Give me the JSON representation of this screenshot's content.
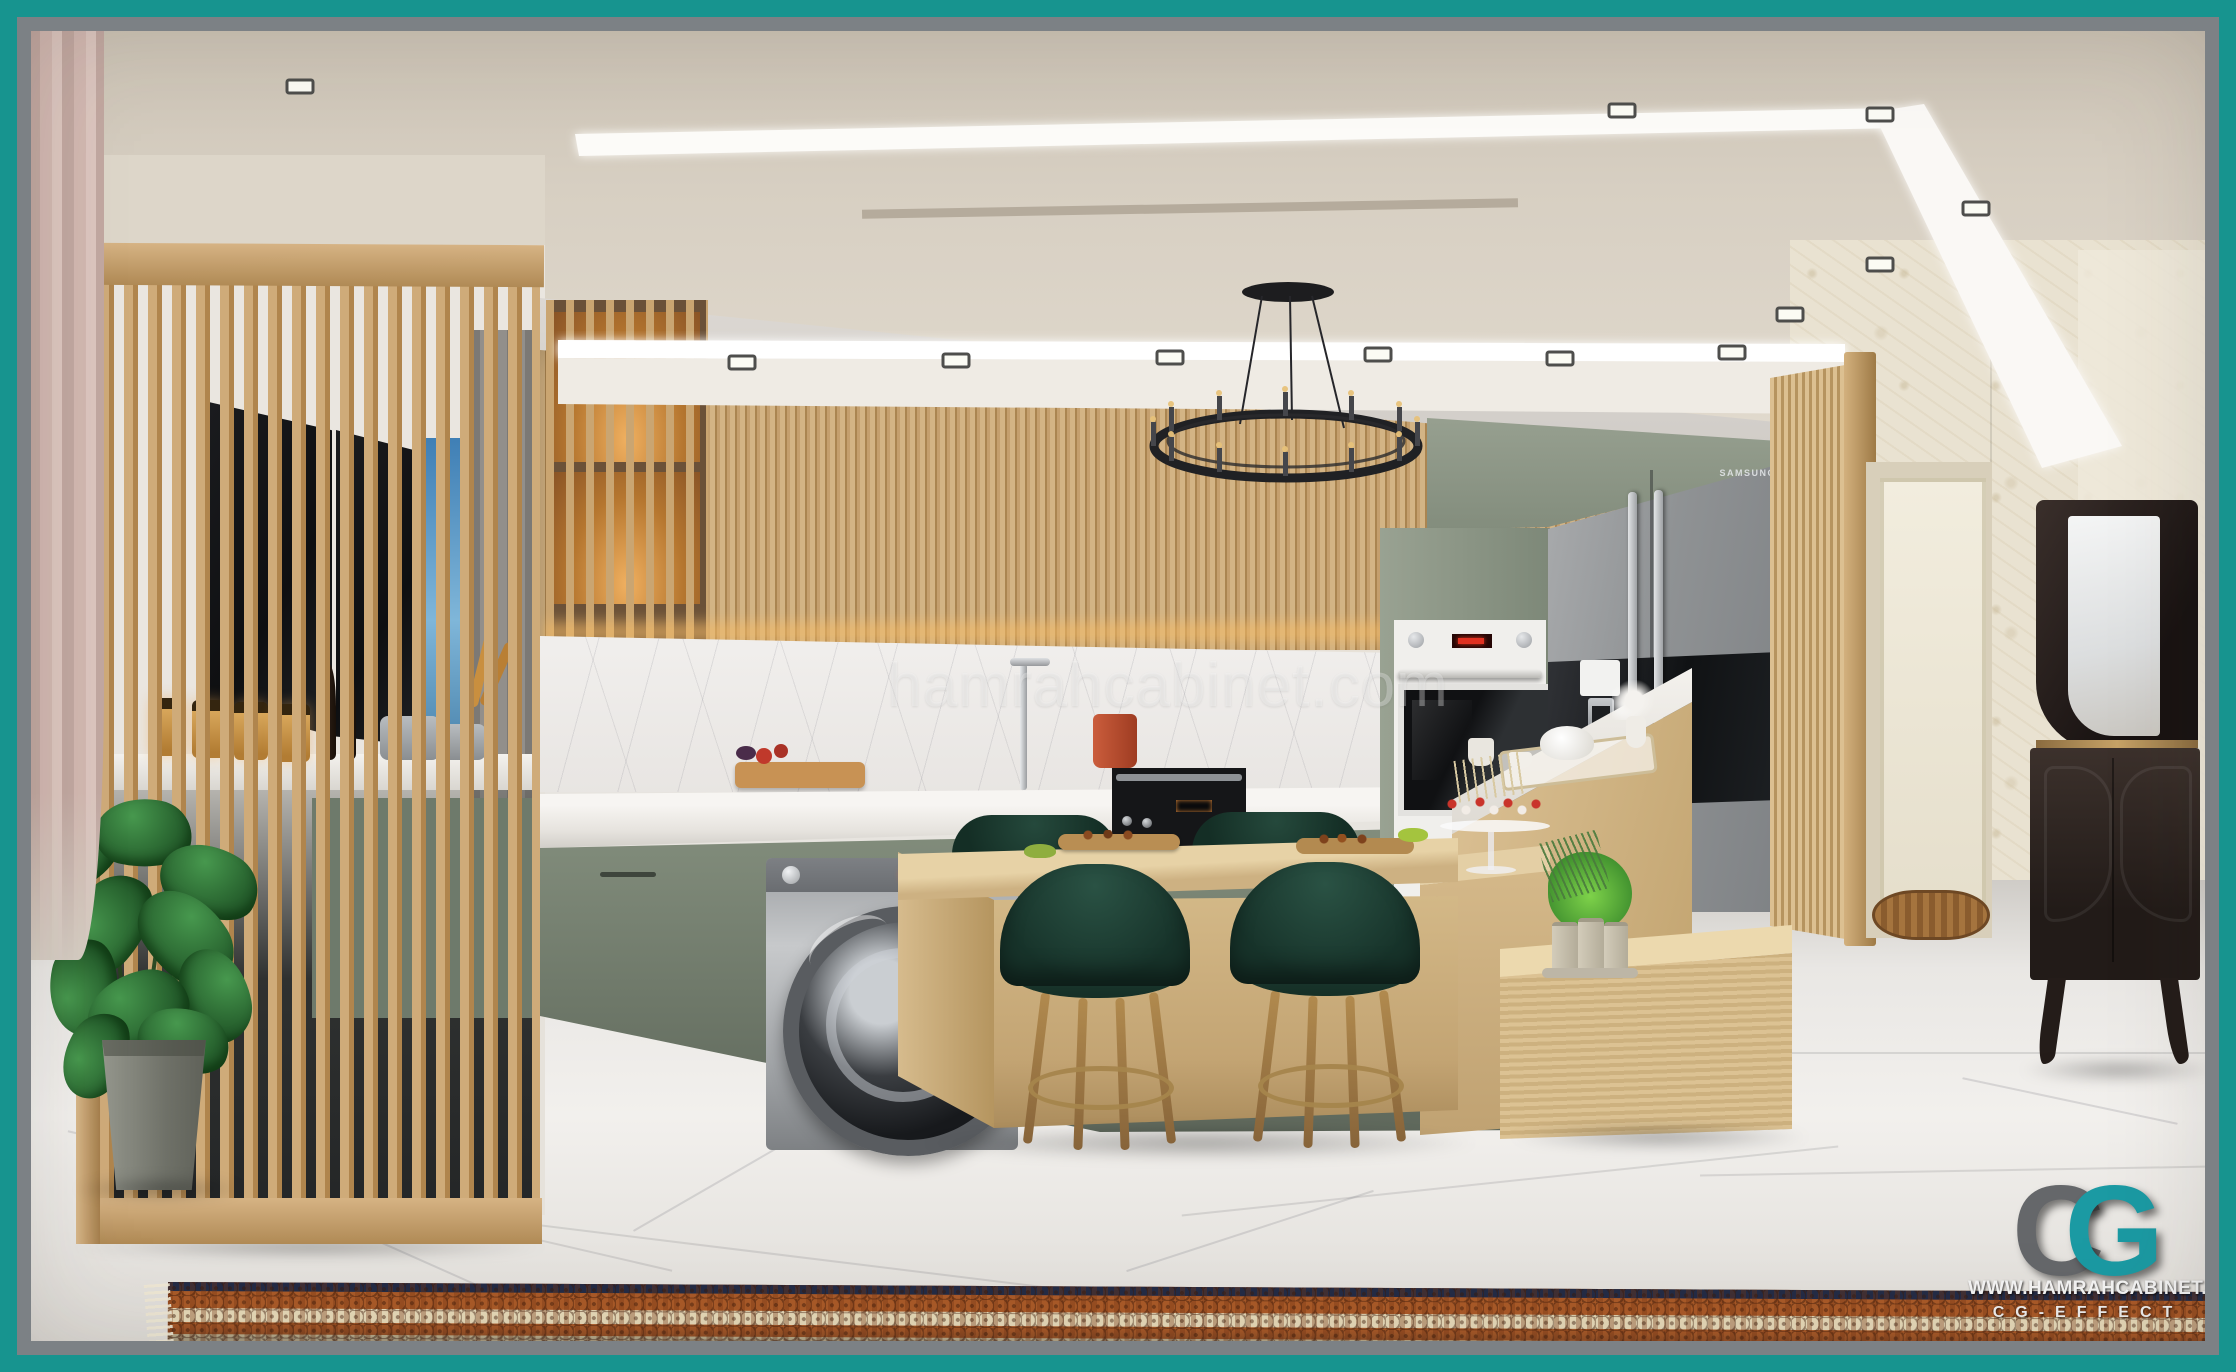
{
  "frame": {
    "outer_color": "#17948f",
    "inner_color": "#7c8185"
  },
  "watermark": {
    "text": "hamrahcabinet.com"
  },
  "fridge": {
    "brand": "SAMSUNG"
  },
  "branding": {
    "logo": {
      "letter_c": "C",
      "letter_g": "G",
      "c_color": "#65676a",
      "g_color": "#1b9aa3"
    },
    "website": "WWW.HAMRAHCABINET.COM",
    "studio": "CG-EFFECT"
  },
  "palette": {
    "cabinet_sage": "#8b9584",
    "wood_light": "#cfae7d",
    "stool_green": "#1d3a31",
    "marble": "#edeae6",
    "rug_rust": "#aa5a28",
    "rug_navy": "#232b46",
    "ceiling_cream": "#d7cfc2"
  },
  "scene": {
    "objects": [
      "wood-slat-partition",
      "indoor-plant",
      "kitchen-cabinets",
      "washing-machine",
      "wall-oven",
      "range-cooker",
      "refrigerator",
      "kitchen-island",
      "bar-stools",
      "ring-chandelier",
      "recessed-downlights",
      "marble-floor",
      "persian-rug",
      "vanity-console-with-mirror",
      "hallway-doorway",
      "slatted-door",
      "curtain"
    ]
  }
}
